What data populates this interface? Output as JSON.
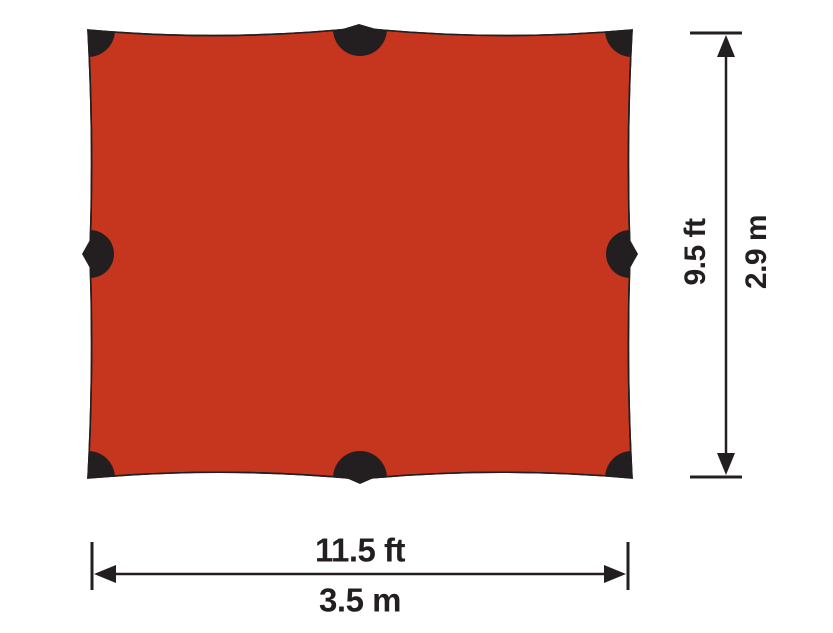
{
  "figure": {
    "subject": "tarp-top-view-dimension-diagram",
    "colors": {
      "tarp_fill": "#C6361F",
      "tarp_outline": "#231F20",
      "attachment_point": "#231F20",
      "dimension_line": "#231F20",
      "background": "#FFFFFF"
    },
    "attachment_point_count": 8,
    "width_dimension": {
      "imperial_label": "11.5 ft",
      "metric_label": "3.5 m"
    },
    "height_dimension": {
      "imperial_label": "9.5 ft",
      "metric_label": "2.9 m"
    }
  }
}
